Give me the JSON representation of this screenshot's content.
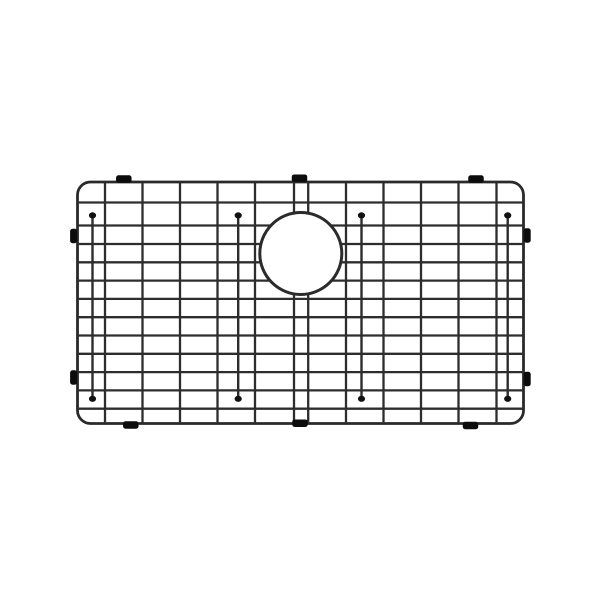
{
  "canvas": {
    "width": 600,
    "height": 600,
    "background": "#ffffff"
  },
  "product": {
    "kind": "stainless-sink-bottom-grid",
    "colors": {
      "wire": "#2d2d2d",
      "frame": "#2a2a2a",
      "drain_ring": "#2b2b2b",
      "bumper": "#0c0c0c",
      "foot": "#111111",
      "background": "#ffffff"
    },
    "frame": {
      "x": 77.5,
      "y": 182,
      "width": 446,
      "height": 241.5,
      "corner_radius": 13,
      "stroke_width": 2.8
    },
    "wires": {
      "stroke_width": 2.3,
      "horizontal_y": [
        202.5,
        225.5,
        244,
        262.3,
        280.6,
        298.9,
        317.2,
        335.5,
        353.8,
        372.1,
        390.4,
        408.7
      ],
      "vertical_x": [
        105,
        142.5,
        180,
        217.5,
        255,
        294,
        308.2,
        346,
        383.5,
        421,
        458.5,
        496.5
      ]
    },
    "drain_hole": {
      "cx": 300.8,
      "cy": 253.5,
      "r": 41,
      "stroke_width": 3,
      "fill": "#ffffff"
    },
    "feet": {
      "stroke_width": 2.4,
      "dot_rx": 3.6,
      "dot_ry": 3.1,
      "top_y": 215.4,
      "bottom_y": 398.8,
      "x": [
        92.5,
        238.2,
        361.5,
        507.7
      ]
    },
    "bumpers": {
      "horizontal_size": {
        "width": 15.5,
        "height": 7.5,
        "rx": 2.5
      },
      "vertical_size": {
        "width": 7,
        "height": 14.5,
        "rx": 2.5
      },
      "top": [
        {
          "cx": 123.8,
          "cy": 179
        },
        {
          "cx": 299.5,
          "cy": 178.2
        },
        {
          "cx": 476.0,
          "cy": 179
        }
      ],
      "bottom": [
        {
          "cx": 130.8,
          "cy": 425
        },
        {
          "cx": 300.0,
          "cy": 423.2
        },
        {
          "cx": 470.5,
          "cy": 425.5
        }
      ],
      "left": [
        {
          "cx": 73.6,
          "cy": 236
        },
        {
          "cx": 73.6,
          "cy": 377.5
        }
      ],
      "right": [
        {
          "cx": 527.2,
          "cy": 235.5
        },
        {
          "cx": 527.2,
          "cy": 379
        }
      ]
    }
  }
}
